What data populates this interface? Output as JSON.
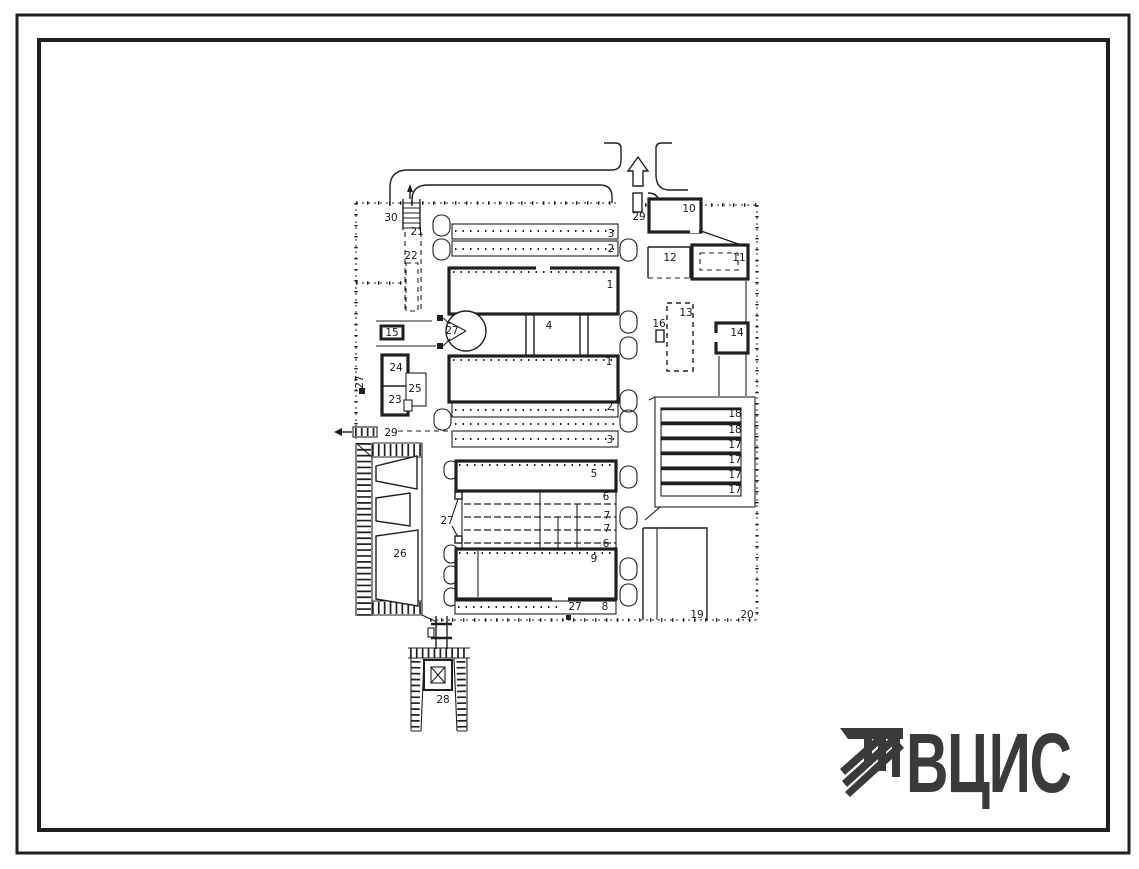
{
  "colors": {
    "ink": "#1f1f1f",
    "paper": "#ffffff",
    "logo": "#3a3a3c"
  },
  "logo": {
    "text": "ВЦИС"
  },
  "plan": {
    "labels": [
      {
        "t": "30",
        "x": 391,
        "y": 221
      },
      {
        "t": "21",
        "x": 417,
        "y": 235
      },
      {
        "t": "22",
        "x": 411,
        "y": 259
      },
      {
        "t": "29",
        "x": 639,
        "y": 220
      },
      {
        "t": "10",
        "x": 689,
        "y": 212
      },
      {
        "t": "12",
        "x": 670,
        "y": 261
      },
      {
        "t": "11",
        "x": 739,
        "y": 261
      },
      {
        "t": "3",
        "x": 611,
        "y": 237
      },
      {
        "t": "2",
        "x": 611,
        "y": 252
      },
      {
        "t": "1",
        "x": 610,
        "y": 288
      },
      {
        "t": "4",
        "x": 549,
        "y": 329
      },
      {
        "t": "27",
        "x": 452,
        "y": 334
      },
      {
        "t": "1",
        "x": 609,
        "y": 365
      },
      {
        "t": "2",
        "x": 610,
        "y": 410
      },
      {
        "t": "3",
        "x": 610,
        "y": 443
      },
      {
        "t": "16",
        "x": 659,
        "y": 327
      },
      {
        "t": "13",
        "x": 686,
        "y": 316
      },
      {
        "t": "14",
        "x": 737,
        "y": 336
      },
      {
        "t": "15",
        "x": 392,
        "y": 336
      },
      {
        "t": "24",
        "x": 396,
        "y": 371
      },
      {
        "t": "25",
        "x": 415,
        "y": 392
      },
      {
        "t": "23",
        "x": 395,
        "y": 403
      },
      {
        "t": "27",
        "x": 363,
        "y": 382,
        "rot": -90
      },
      {
        "t": "29",
        "x": 391,
        "y": 436
      },
      {
        "t": "26",
        "x": 400,
        "y": 557
      },
      {
        "t": "5",
        "x": 594,
        "y": 477
      },
      {
        "t": "6",
        "x": 606,
        "y": 500
      },
      {
        "t": "7",
        "x": 607,
        "y": 519
      },
      {
        "t": "7",
        "x": 607,
        "y": 532
      },
      {
        "t": "6",
        "x": 606,
        "y": 547
      },
      {
        "t": "9",
        "x": 594,
        "y": 562
      },
      {
        "t": "27",
        "x": 447,
        "y": 524
      },
      {
        "t": "27",
        "x": 575,
        "y": 610
      },
      {
        "t": "8",
        "x": 605,
        "y": 610
      },
      {
        "t": "18",
        "x": 735,
        "y": 417
      },
      {
        "t": "18",
        "x": 735,
        "y": 433
      },
      {
        "t": "17",
        "x": 735,
        "y": 448
      },
      {
        "t": "17",
        "x": 735,
        "y": 463
      },
      {
        "t": "17",
        "x": 735,
        "y": 478
      },
      {
        "t": "17",
        "x": 735,
        "y": 493
      },
      {
        "t": "19",
        "x": 697,
        "y": 618
      },
      {
        "t": "20",
        "x": 747,
        "y": 618
      },
      {
        "t": "28",
        "x": 443,
        "y": 703
      }
    ]
  }
}
